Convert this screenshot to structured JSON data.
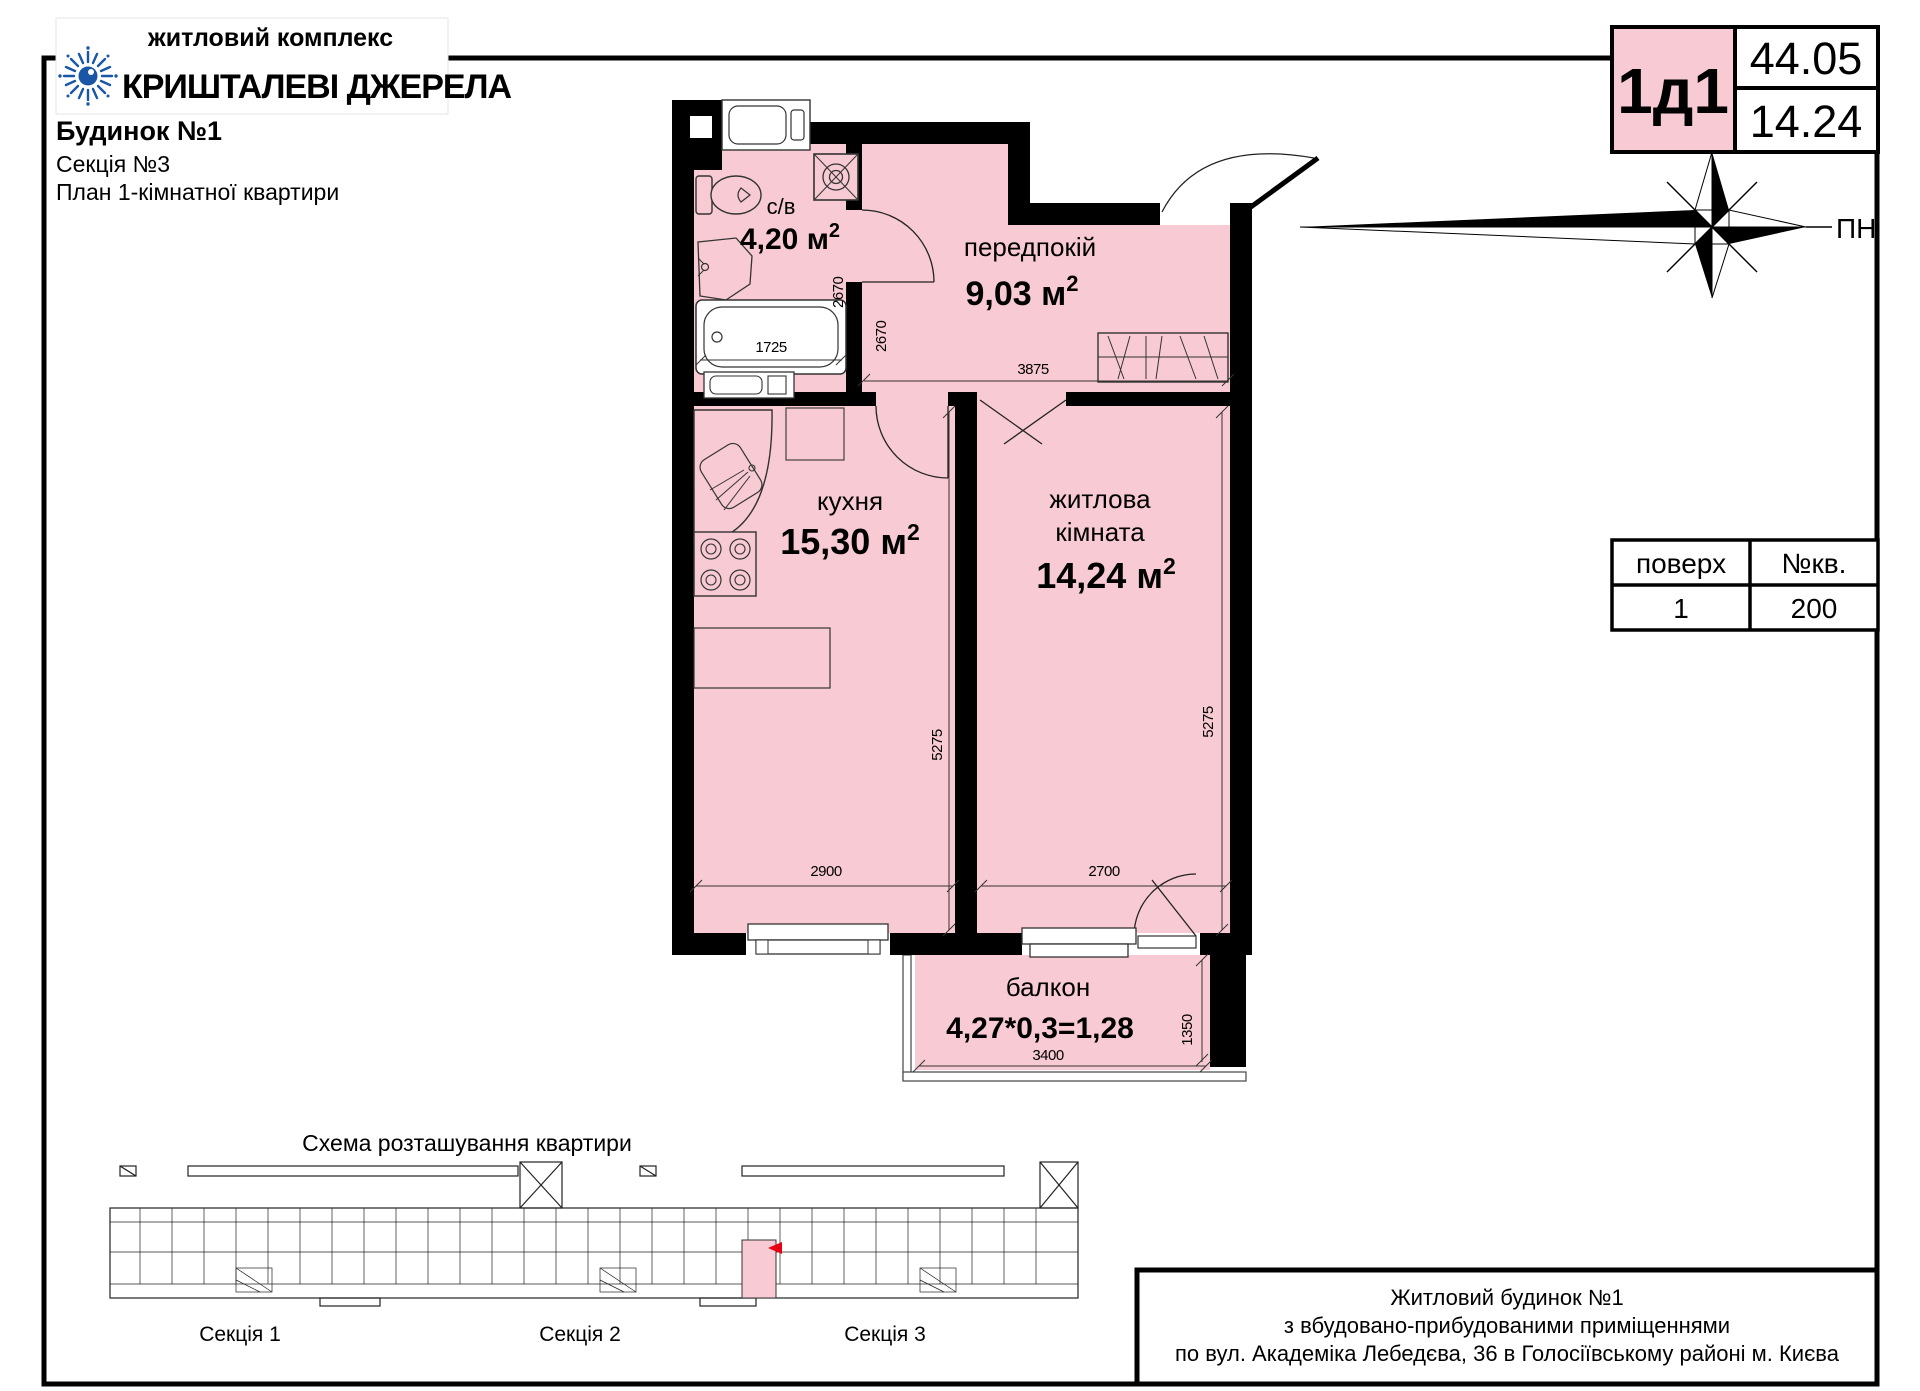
{
  "header": {
    "complex_label": "житловий комплекс",
    "complex_name": "КРИШТАЛЕВІ ДЖЕРЕЛА",
    "building": "Будинок №1",
    "section": "Секція №3",
    "plan_type": "План 1-кімнатної квартири"
  },
  "unit_card": {
    "code": "1д1",
    "total_area": "44.05",
    "living_area": "14.24"
  },
  "compass": {
    "north_label": "ПН"
  },
  "info_table": {
    "floor_header": "поверх",
    "apt_header": "№кв.",
    "floor": "1",
    "apt": "200"
  },
  "rooms": {
    "bathroom": {
      "name": "с/в",
      "area": "4,20 м",
      "sup": "2"
    },
    "hall": {
      "name": "передпокій",
      "area": "9,03 м",
      "sup": "2"
    },
    "kitchen": {
      "name": "кухня",
      "area": "15,30 м",
      "sup": "2"
    },
    "living": {
      "name_line1": "житлова",
      "name_line2": "кімната",
      "area": "14,24 м",
      "sup": "2"
    },
    "balcony": {
      "name": "балкон",
      "area_formula": "4,27*0,3=1,28"
    }
  },
  "dimensions": {
    "bath_width": "1725",
    "bath_height": "2670",
    "hall_height": "2670",
    "hall_width": "3875",
    "kitchen_height": "5275",
    "kitchen_width": "2900",
    "living_height": "5275",
    "living_width": "2700",
    "balcony_width": "3400",
    "balcony_depth": "1350"
  },
  "scheme": {
    "title": "Схема розташування квартири",
    "sections": [
      "Секція 1",
      "Секція 2",
      "Секція 3"
    ]
  },
  "footer": {
    "line1": "Житловий будинок №1",
    "line2": "з вбудовано-прибудованими приміщеннями",
    "line3": "по вул. Академіка Лебедєва, 36 в Голосіївському районі м. Києва"
  },
  "colors": {
    "pink": "#f8cad3",
    "blue": "#1956a5",
    "red": "#e60013"
  }
}
